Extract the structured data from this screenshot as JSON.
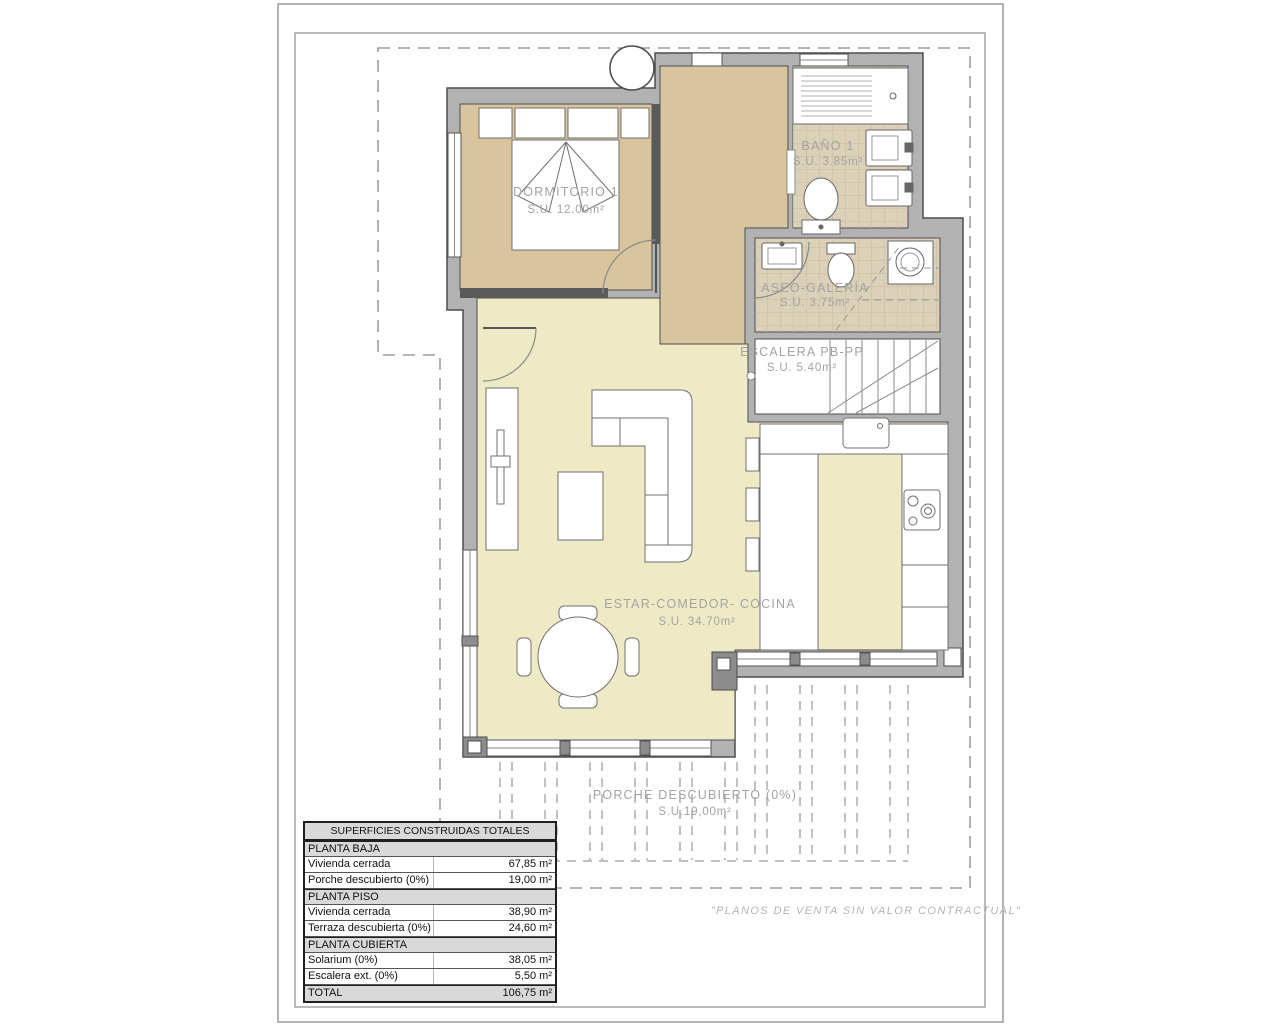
{
  "plan": {
    "rooms": {
      "dormitorio": {
        "name": "DORMITORIO 1",
        "area": "S.U. 12.00m²"
      },
      "bano": {
        "name": "BAÑO 1",
        "area": "S.U. 3.85m²"
      },
      "aseo": {
        "name": "ASEO-GALERÍA",
        "area": "S.U. 3.75m²"
      },
      "escalera": {
        "name": "ESCALERA PB-PP",
        "area": "S.U. 5.40m²"
      },
      "estar": {
        "name": "ESTAR-COMEDOR- COCINA",
        "area": "S.U. 34.70m²"
      },
      "porche": {
        "name": "PORCHE DESCUBIERTO (0%)",
        "area": "S.U.19,00m²"
      }
    },
    "disclaimer": "\"PLANOS DE VENTA SIN VALOR CONTRACTUAL\""
  },
  "table": {
    "title": "SUPERFICIES CONSTRUIDAS TOTALES",
    "rows": [
      {
        "type": "section",
        "label": "PLANTA BAJA",
        "value": ""
      },
      {
        "type": "data",
        "label": "Vivienda cerrada",
        "value": "67,85 m²"
      },
      {
        "type": "data",
        "label": "Porche descubierto (0%)",
        "value": "19,00 m²"
      },
      {
        "type": "section",
        "label": "PLANTA PISO",
        "value": ""
      },
      {
        "type": "data",
        "label": "Vivienda cerrada",
        "value": "38,90 m²"
      },
      {
        "type": "data",
        "label": "Terraza descubierta (0%)",
        "value": "24,60 m²"
      },
      {
        "type": "section",
        "label": "PLANTA CUBIERTA",
        "value": ""
      },
      {
        "type": "data",
        "label": "Solarium (0%)",
        "value": "38,05 m²"
      },
      {
        "type": "data",
        "label": "Escalera ext. (0%)",
        "value": "5,50 m²"
      },
      {
        "type": "total",
        "label": "TOTAL",
        "value": "106,75 m²"
      }
    ]
  },
  "colors": {
    "wall": "#b2b2b2",
    "wall_outline": "#4d4d4d",
    "floor_bedroom": "#d8c59e",
    "floor_tiled": "#dbd1b8",
    "floor_living": "#eeeac5",
    "label_gray": "#a3a3a3"
  }
}
